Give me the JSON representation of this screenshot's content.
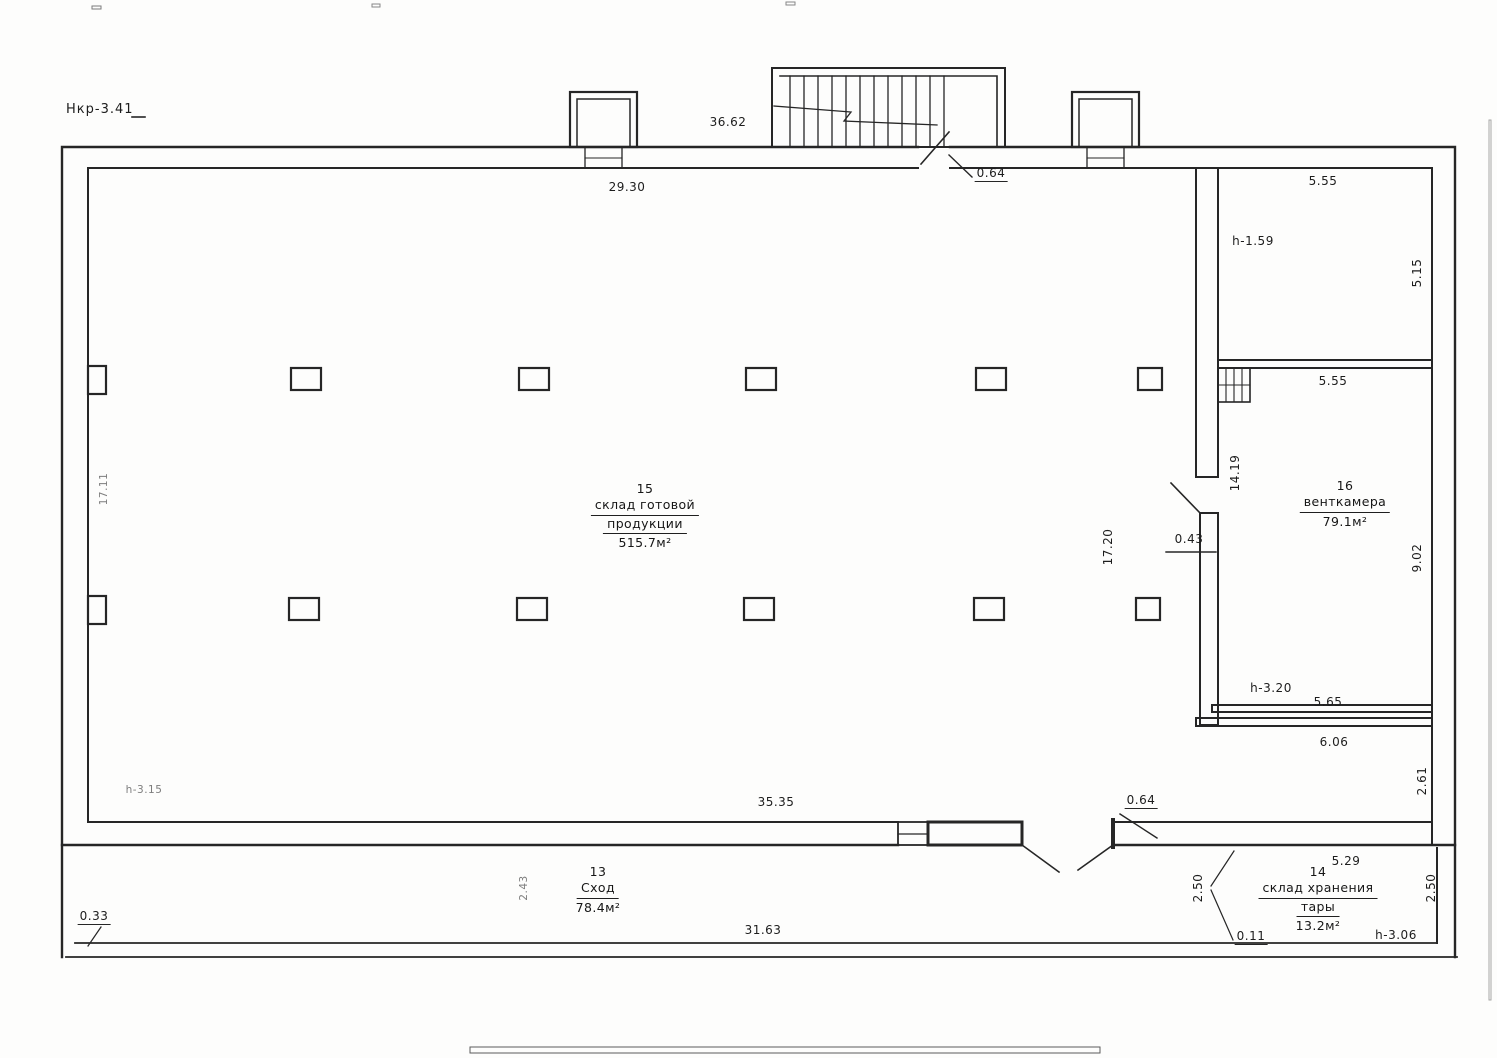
{
  "drawing_code": "Нкр-3.41",
  "rooms": {
    "main": {
      "number": "15",
      "name1": "склад готовой",
      "name2": "продукции",
      "area": "515.7м²"
    },
    "vent": {
      "number": "16",
      "name1": "венткамера",
      "area": "79.1м²"
    },
    "ramp": {
      "number": "13",
      "name1": "Сход",
      "area": "78.4м²"
    },
    "tare": {
      "number": "14",
      "name1": "склад хранения",
      "name2": "тары",
      "area": "13.2м²"
    }
  },
  "dims": {
    "top_outer": "36.62",
    "top_inner": "29.30",
    "top_door": "0.64",
    "r17_width": "5.55",
    "r17_h": "h-1.59",
    "r17_right": "5.15",
    "vent_width": "5.55",
    "wall_len": "14.19",
    "hall_left": "17.11",
    "hall_right": "17.20",
    "gap": "0.43",
    "vent_right": "9.02",
    "vent_h": "h-3.20",
    "vent_bottom": "5.65",
    "niche_w": "6.06",
    "niche_h": "2.61",
    "hall_h": "h-3.15",
    "bottom_inner": "35.35",
    "bottom_door": "0.64",
    "tare_left": "2.50",
    "tare_top": "5.29",
    "tare_off": "0.11",
    "tare_h": "h-3.06",
    "tare_right": "2.50",
    "ramp_gap": "0.33",
    "ramp_w": "2.43",
    "ramp_len": "31.63"
  }
}
